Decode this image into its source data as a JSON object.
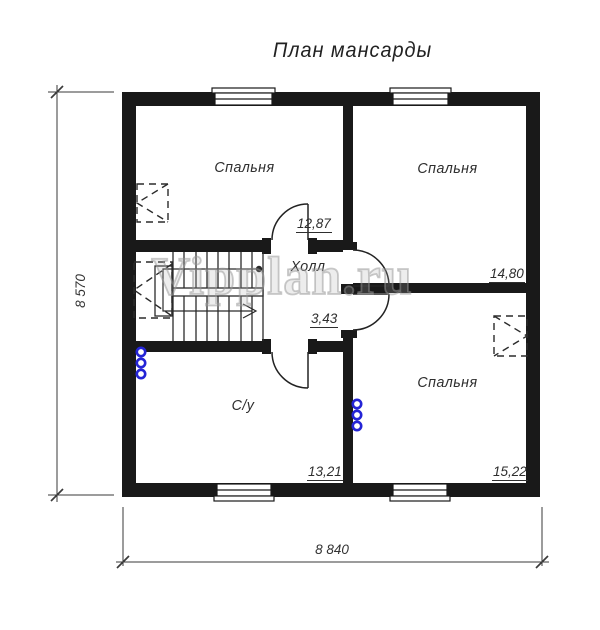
{
  "title": "План мансарды",
  "watermark": "Vipplan.ru",
  "rooms": {
    "bedroom_top_left": {
      "name": "Спальня",
      "area": "12,87"
    },
    "bedroom_top_right": {
      "name": "Спальня",
      "area": "14,80"
    },
    "hall": {
      "name": "Холл",
      "area": "3,43"
    },
    "bathroom": {
      "name": "С/у",
      "area": "13,21"
    },
    "bedroom_bottom_right": {
      "name": "Спальня",
      "area": "15,22"
    }
  },
  "dimensions": {
    "overall_width": "8 840",
    "overall_height": "8 570"
  },
  "colors": {
    "wall": "#191919",
    "thin_line": "#2b2b2b",
    "plumbing_riser": "#2424d6",
    "watermark_gray": "#b5b5b5"
  }
}
